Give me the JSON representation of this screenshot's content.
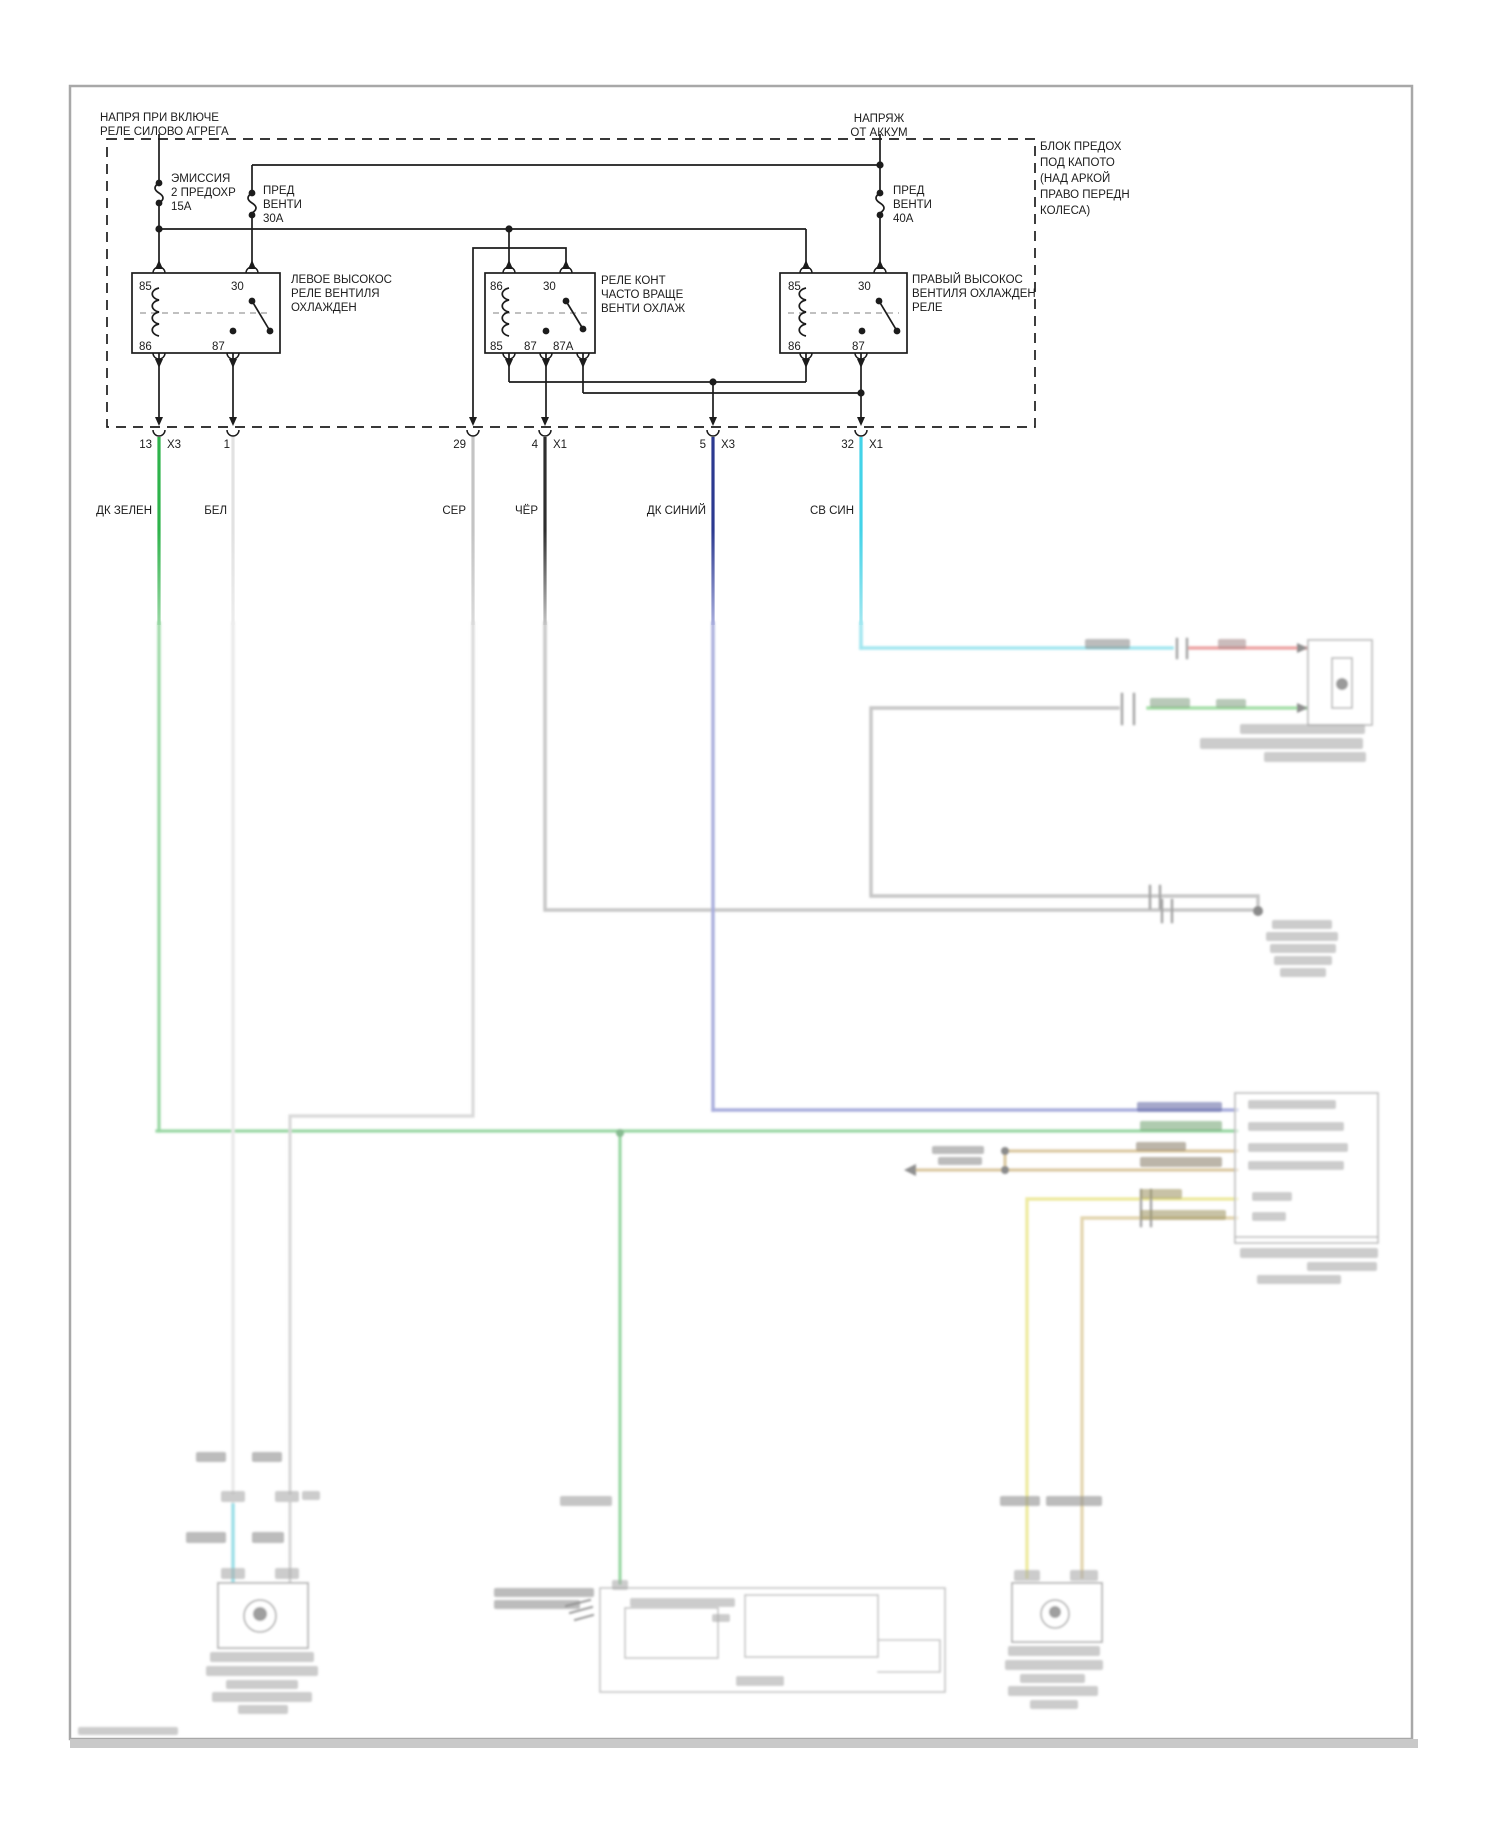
{
  "feeds": {
    "left": [
      "НАПРЯ ПРИ ВКЛЮЧЕ",
      "РЕЛЕ СИЛОВО АГРЕГА"
    ],
    "right": [
      "НАПРЯЖ",
      "ОТ АККУМ"
    ]
  },
  "fuse_block_note": [
    "БЛОК ПРЕДОХ",
    "ПОД КАПОТО",
    "(НАД АРКОЙ",
    "ПРАВО ПЕРЕДН",
    "КОЛЕСА)"
  ],
  "fuses": {
    "emission": [
      "ЭМИССИЯ",
      "2 ПРЕДОХР",
      "15А"
    ],
    "fan30": [
      "ПРЕД",
      "ВЕНТИ",
      "30А"
    ],
    "fan40": [
      "ПРЕД",
      "ВЕНТИ",
      "40А"
    ]
  },
  "relays": {
    "left": {
      "label": [
        "ЛЕВОЕ ВЫСОКОС",
        "РЕЛЕ ВЕНТИЛЯ",
        "ОХЛАЖДЕН"
      ],
      "pins": {
        "tl": "85",
        "tr": "30",
        "bl": "86",
        "bm": "87"
      }
    },
    "middle": {
      "label": [
        "РЕЛЕ КОНТ",
        "ЧАСТО ВРАЩЕ",
        "ВЕНТИ ОХЛАЖ"
      ],
      "pins": {
        "tl": "86",
        "tr": "30",
        "bl": "85",
        "bm": "87",
        "br": "87A"
      }
    },
    "right": {
      "label": [
        "ПРАВЫЙ ВЫСОКОС",
        "ВЕНТИЛЯ ОХЛАЖДЕН",
        "РЕЛЕ"
      ],
      "pins": {
        "tl": "85",
        "tr": "30",
        "bl": "86",
        "bm": "87"
      }
    }
  },
  "connector_pins": [
    {
      "num": "13",
      "conn": "X3"
    },
    {
      "num": "1",
      "conn": ""
    },
    {
      "num": "29",
      "conn": ""
    },
    {
      "num": "4",
      "conn": "X1"
    },
    {
      "num": "5",
      "conn": "X3"
    },
    {
      "num": "32",
      "conn": "X1"
    }
  ],
  "wire_colors": [
    "ДК ЗЕЛЕН",
    "БЕЛ",
    "СЕР",
    "ЧЁР",
    "ДК СИНИЙ",
    "СВ СИН"
  ],
  "palette": {
    "line": "#1c1c1c",
    "green": "#2eb34b",
    "green_faded": "#98d7a3",
    "white_wire": "#e2e2e2",
    "white_wire_faded": "#ededed",
    "gray": "#c4c4c4",
    "gray_faded": "#dadada",
    "black_wire": "#2e2e2e",
    "black_wire_faded": "#c4c4c4",
    "dark_blue": "#2c3a90",
    "dark_blue_faded": "#a9aedd",
    "cyan": "#43d3e8",
    "cyan_faded": "#a3e7f0",
    "red_faded": "#eda5a5",
    "lt_green_faded": "#a5dfa8",
    "tan_faded": "#dcc9a2",
    "yellow_faded": "#eeeaa0",
    "smudge": "#ababab",
    "box_faded": "#bfbfbf",
    "page_border": "#a8a8a8"
  }
}
